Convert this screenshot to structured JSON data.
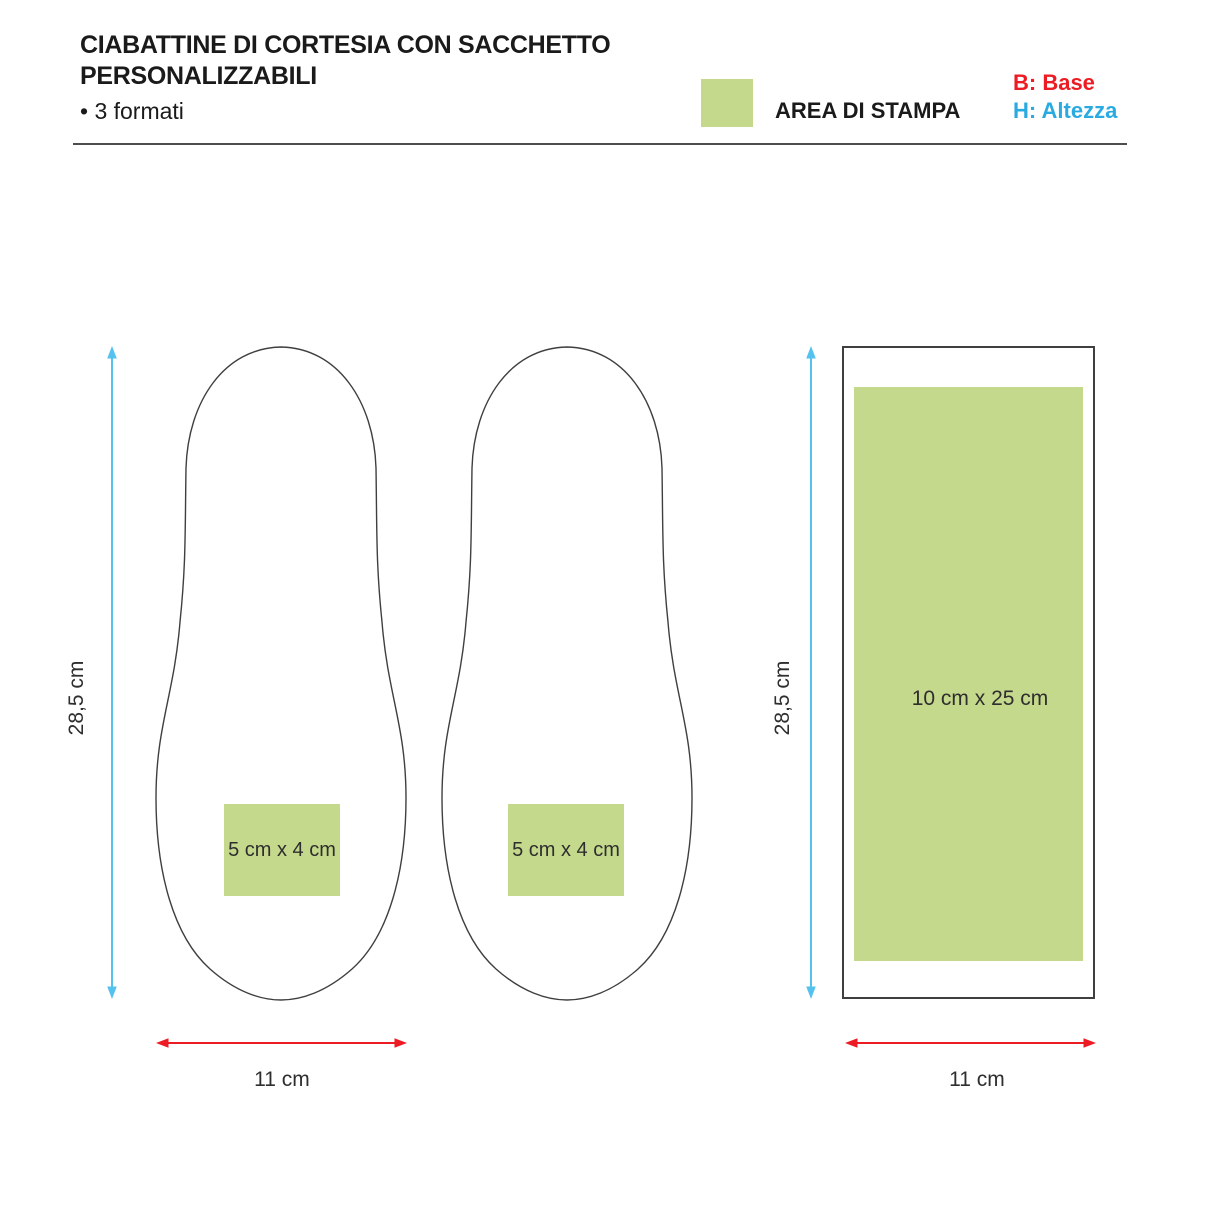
{
  "header": {
    "title_line1": "CIABATTINE DI CORTESIA CON SACCHETTO",
    "title_line2": "PERSONALIZZABILI",
    "subtitle": "• 3 formati"
  },
  "legend": {
    "print_area_label": "AREA DI STAMPA",
    "key_base": "B: Base",
    "key_height": "H: Altezza"
  },
  "diagram": {
    "slipper_left": {
      "print_area_label": "5 cm x 4 cm"
    },
    "slipper_right": {
      "print_area_label": "5 cm x 4 cm"
    },
    "bag": {
      "print_area_label": "10 cm x 25 cm"
    },
    "dimensions": {
      "slippers_height": "28,5 cm",
      "slippers_width": "11 cm",
      "bag_height": "28,5 cm",
      "bag_width": "11 cm"
    }
  },
  "colors": {
    "print-green": "#c5d98c",
    "dim-red": "#ed1c24",
    "dim-blue": "#54c2ee",
    "key-red": "#ed1c24",
    "key-blue": "#29abe2",
    "outline-gray": "#3f3f3f",
    "rule-gray": "#4d4d4d",
    "text-dark": "#1a1a1a",
    "label-gray": "#2e2e2e"
  }
}
